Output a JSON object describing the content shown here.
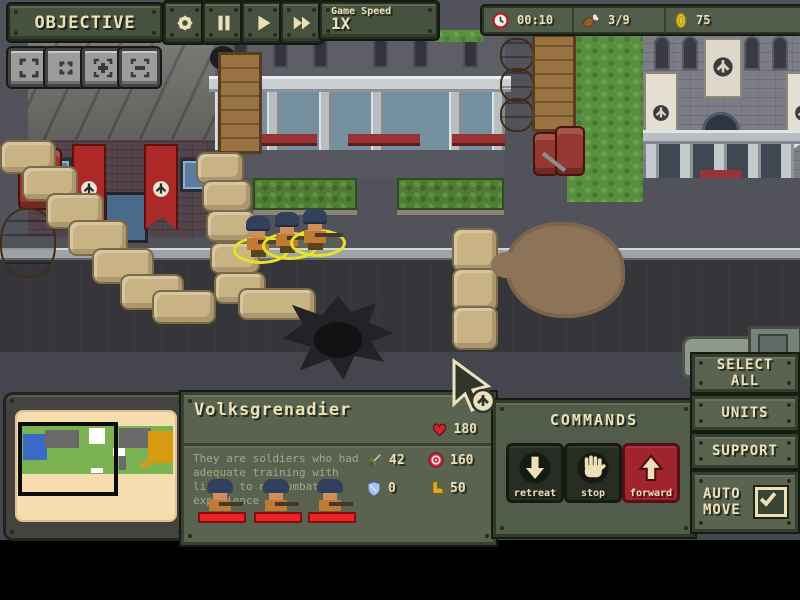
{
  "toolbar": {
    "objective": "OBJECTIVE",
    "game_speed_label": "Game Speed",
    "game_speed_value": "1X"
  },
  "resources": {
    "time": "00:10",
    "rations": "3/9",
    "gold": "75"
  },
  "unit_panel": {
    "name": "Volksgrenadier",
    "health": "180",
    "description": "They are soldiers who had adequate training with little to no combat experience",
    "stats": {
      "attack": "42",
      "range": "160",
      "armor": "0",
      "speed": "50"
    }
  },
  "commands": {
    "title": "COMMANDS",
    "retreat": "retreat",
    "stop": "stop",
    "forward": "forward"
  },
  "side_panel": {
    "select_all": "SELECT ALL",
    "units": "UNITS",
    "support": "SUPPORT",
    "auto_move": "AUTO MOVE",
    "auto_move_checked": true
  },
  "colors": {
    "panel_green": "#515c4b",
    "panel_border": "#333d2b",
    "cream_text": "#ece0b6",
    "accent_red": "#a02330",
    "health_red": "#ee2222",
    "coin_gold": "#e8c832",
    "selection_yellow": "#e6e22c",
    "minimap_paper": "#f6ddb0"
  }
}
